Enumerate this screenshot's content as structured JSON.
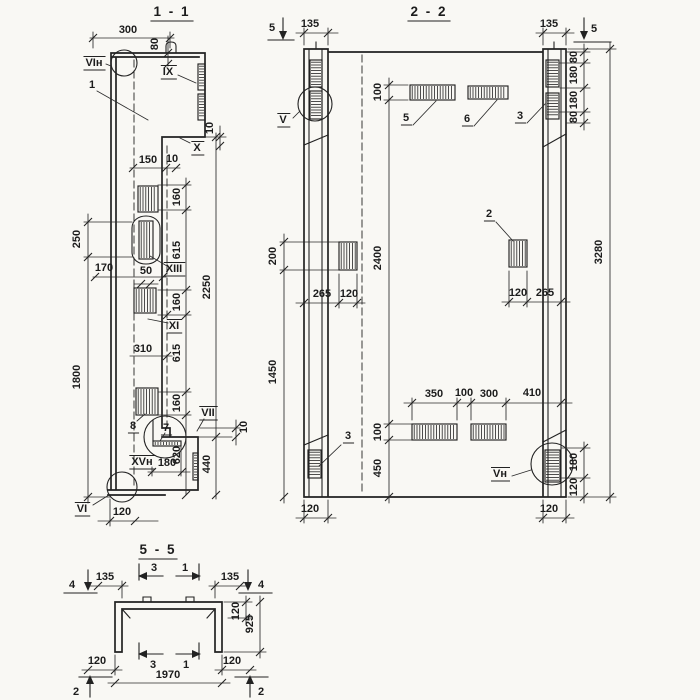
{
  "palette": {
    "paper": "#f9f8f4",
    "ink": "#222222"
  },
  "s11": {
    "title": "1 - 1",
    "views": {
      "vi_n": "VIн",
      "ix": "IX",
      "x": "X",
      "xiii": "XIII",
      "xi": "XI",
      "vii": "VII",
      "xv_n": "XVн",
      "vi": "VI"
    },
    "parts": {
      "p1": "1",
      "p7": "7",
      "p8": "8"
    },
    "dims": {
      "w300": "300",
      "v80": "80",
      "v10_top": "10",
      "w150": "150",
      "w10": "10",
      "v160a": "160",
      "v615a": "615",
      "v160b": "160",
      "v310": "310",
      "v615b": "615",
      "v160c": "160",
      "v2250": "2250",
      "v440": "440",
      "v620": "620",
      "v250": "250",
      "v1800": "1800",
      "h170": "170",
      "h50": "50",
      "h180": "180",
      "v10_bot": "10",
      "w120": "120"
    }
  },
  "s22": {
    "title": "2 - 2",
    "views": {
      "v": "V",
      "v_n": "Vн"
    },
    "parts": {
      "p2": "2",
      "p3_top": "3",
      "p3_bot": "3",
      "p5": "5",
      "p6": "6"
    },
    "markers": {
      "m5_left": "5",
      "m5_right": "5"
    },
    "dims": {
      "w135_l": "135",
      "w135_r": "135",
      "v80a": "80",
      "v180a": "180",
      "v180b": "180",
      "v80b": "80",
      "v100_top": "100",
      "v2400": "2400",
      "v100_bot": "100",
      "v450": "450",
      "v200": "200",
      "v1450": "1450",
      "v3280": "3280",
      "h265_l": "265",
      "h120_l": "120",
      "h120_r": "120",
      "h265_r": "265",
      "h350": "350",
      "h100": "100",
      "h300": "300",
      "h410": "410",
      "v180_br": "180",
      "v120_br": "120",
      "w120_bl": "120",
      "w120_brc": "120"
    }
  },
  "s55": {
    "title": "5 - 5",
    "markers": {
      "m4_l": "4",
      "m4_r": "4",
      "m3_top": "3",
      "m1_top": "1",
      "m3_bot": "3",
      "m1_bot": "1",
      "m2_l": "2",
      "m2_r": "2"
    },
    "dims": {
      "w135_l": "135",
      "w135_r": "135",
      "v120": "120",
      "v925": "925",
      "w120_l": "120",
      "w120_r": "120",
      "w1970": "1970"
    }
  }
}
